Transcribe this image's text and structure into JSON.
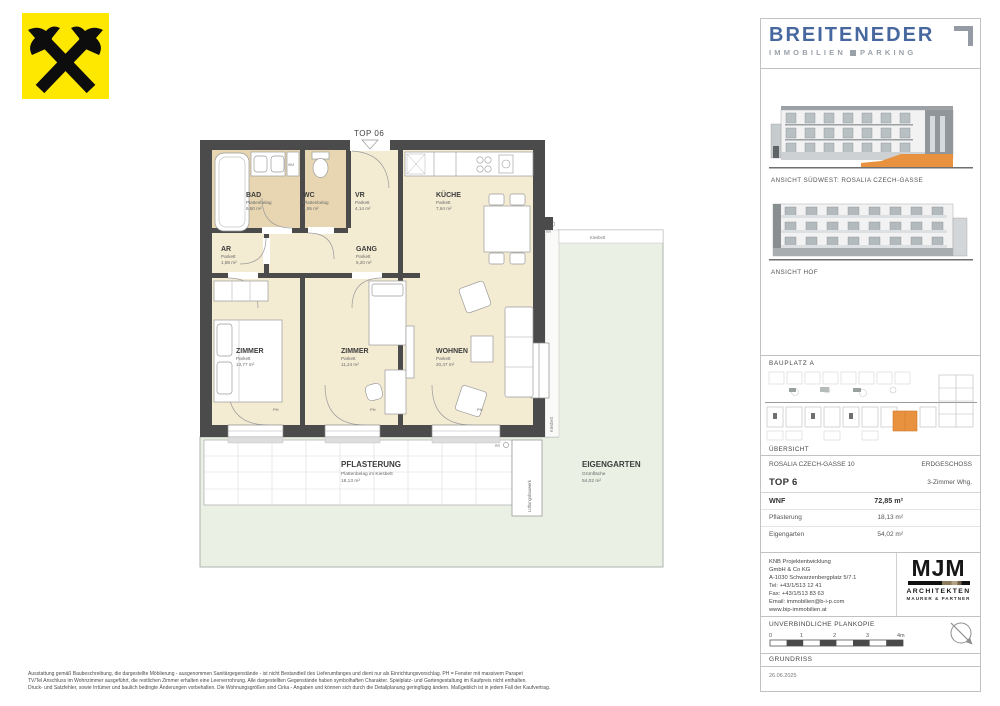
{
  "plan": {
    "top_label": "TOP 06",
    "rooms": [
      {
        "name": "BAD",
        "surface": "Plattenbelag",
        "area": "6,50 m²"
      },
      {
        "name": "WC",
        "surface": "Plattenbelag",
        "area": "1,95 m²"
      },
      {
        "name": "VR",
        "surface": "Parkett",
        "area": "4,14 m²"
      },
      {
        "name": "KÜCHE",
        "surface": "Parkett",
        "area": "7,64 m²"
      },
      {
        "name": "AR",
        "surface": "Parkett",
        "area": "1,88 m²"
      },
      {
        "name": "GANG",
        "surface": "Parkett",
        "area": "5,20 m²"
      },
      {
        "name": "ZIMMER",
        "surface": "Parkett",
        "area": "13,77 m²"
      },
      {
        "name": "ZIMMER",
        "surface": "Parkett",
        "area": "11,24 m²"
      },
      {
        "name": "WOHNEN",
        "surface": "Parkett",
        "area": "20,47 m²"
      }
    ],
    "outdoor": {
      "pflasterung": {
        "name": "PFLASTERUNG",
        "surface": "Plattenbelag im Kiesbett",
        "area": "18,13 m²"
      },
      "eigengarten": {
        "name": "EIGENGARTEN",
        "surface": "Grünfläche",
        "area": "54,02 m²"
      }
    },
    "annotations": {
      "kiesbett": "Kiesbett",
      "lueftung": "Lüftungsbauwerk",
      "wm": "WM",
      "ph": "PH",
      "rr": "RR"
    }
  },
  "sidebar": {
    "brand": {
      "name": "BREITENEDER",
      "tagline_left": "IMMOBILIEN",
      "tagline_right": "PARKING"
    },
    "views": [
      {
        "caption": "ANSICHT SÜDWEST: ROSALIA CZECH-GASSE"
      },
      {
        "caption": "ANSICHT HOF"
      }
    ],
    "site_plan": {
      "top_label": "BAUPLATZ  A",
      "bottom_label": "ÜBERSICHT"
    },
    "info": {
      "address": "ROSALIA CZECH-GASSE 10",
      "floor": "ERDGESCHOSS",
      "unit": "TOP 6",
      "unit_type": "3-Zimmer Whg.",
      "rows": [
        {
          "label": "WNF",
          "value": "72,85 m²"
        },
        {
          "label": "Pflasterung",
          "value": "18,13 m²"
        },
        {
          "label": "Eigengarten",
          "value": "54,02 m²"
        }
      ]
    },
    "developer": {
      "lines": [
        "KNB Projektentwicklung",
        "GmbH & Co KG",
        "A-1030 Schwarzenbergplatz 5/7.1",
        "Tel: +43/1/513 12 41",
        "Fax: +43/1/513 83 63",
        "Email: immobilien@b-i-p.com",
        "www.bip-immobilien.at"
      ]
    },
    "architect": {
      "logo": "MJM",
      "line1": "ARCHITEKTEN",
      "line2": "MAURER & PARTNER"
    },
    "plan_copy_note": "UNVERBINDLICHE PLANKOPIE",
    "scale": {
      "ticks": [
        "0",
        "1",
        "2",
        "3",
        "4m"
      ]
    },
    "drawing_type": "GRUNDRISS",
    "date": "26.06.2025"
  },
  "footer": {
    "lines": [
      "Ausstattung gemäß Baubeschreibung, die dargestellte Möblierung - ausgenommen Sanitärgegenstände - ist nicht Bestandteil des Lieferumfanges und dient nur als Einrichtungsvorschlag. PH = Fenster mit massivem Parapet",
      "TV/Tel Anschluss im Wohnzimmer ausgeführt, die restlichen Zimmer erhalten eine Leerverrohrung. Alle dargestellten Gegenstände haben symbolhaften Charakter. Spielplatz- und Gartengestaltung im Kaufpreis nicht enthalten.",
      "Druck- und Satzfehler, sowie Irrtümer und baulich bedingte Änderungen vorbehalten. Die Wohnungsgrößen sind Cirka - Angaben und können sich durch die Detailplanung geringfügig ändern. Maßgeblich ist in jedem Fall der Kaufvertrag."
    ]
  },
  "colors": {
    "accent_orange": "#E8913F",
    "brand_blue": "#47679F",
    "wall_gray": "#4B4B4B",
    "floor_light": "#F4EBD3",
    "floor_tile": "#E7D6B1",
    "garden_green": "#EAF0E4",
    "raiffeisen_yellow": "#FFE800"
  }
}
